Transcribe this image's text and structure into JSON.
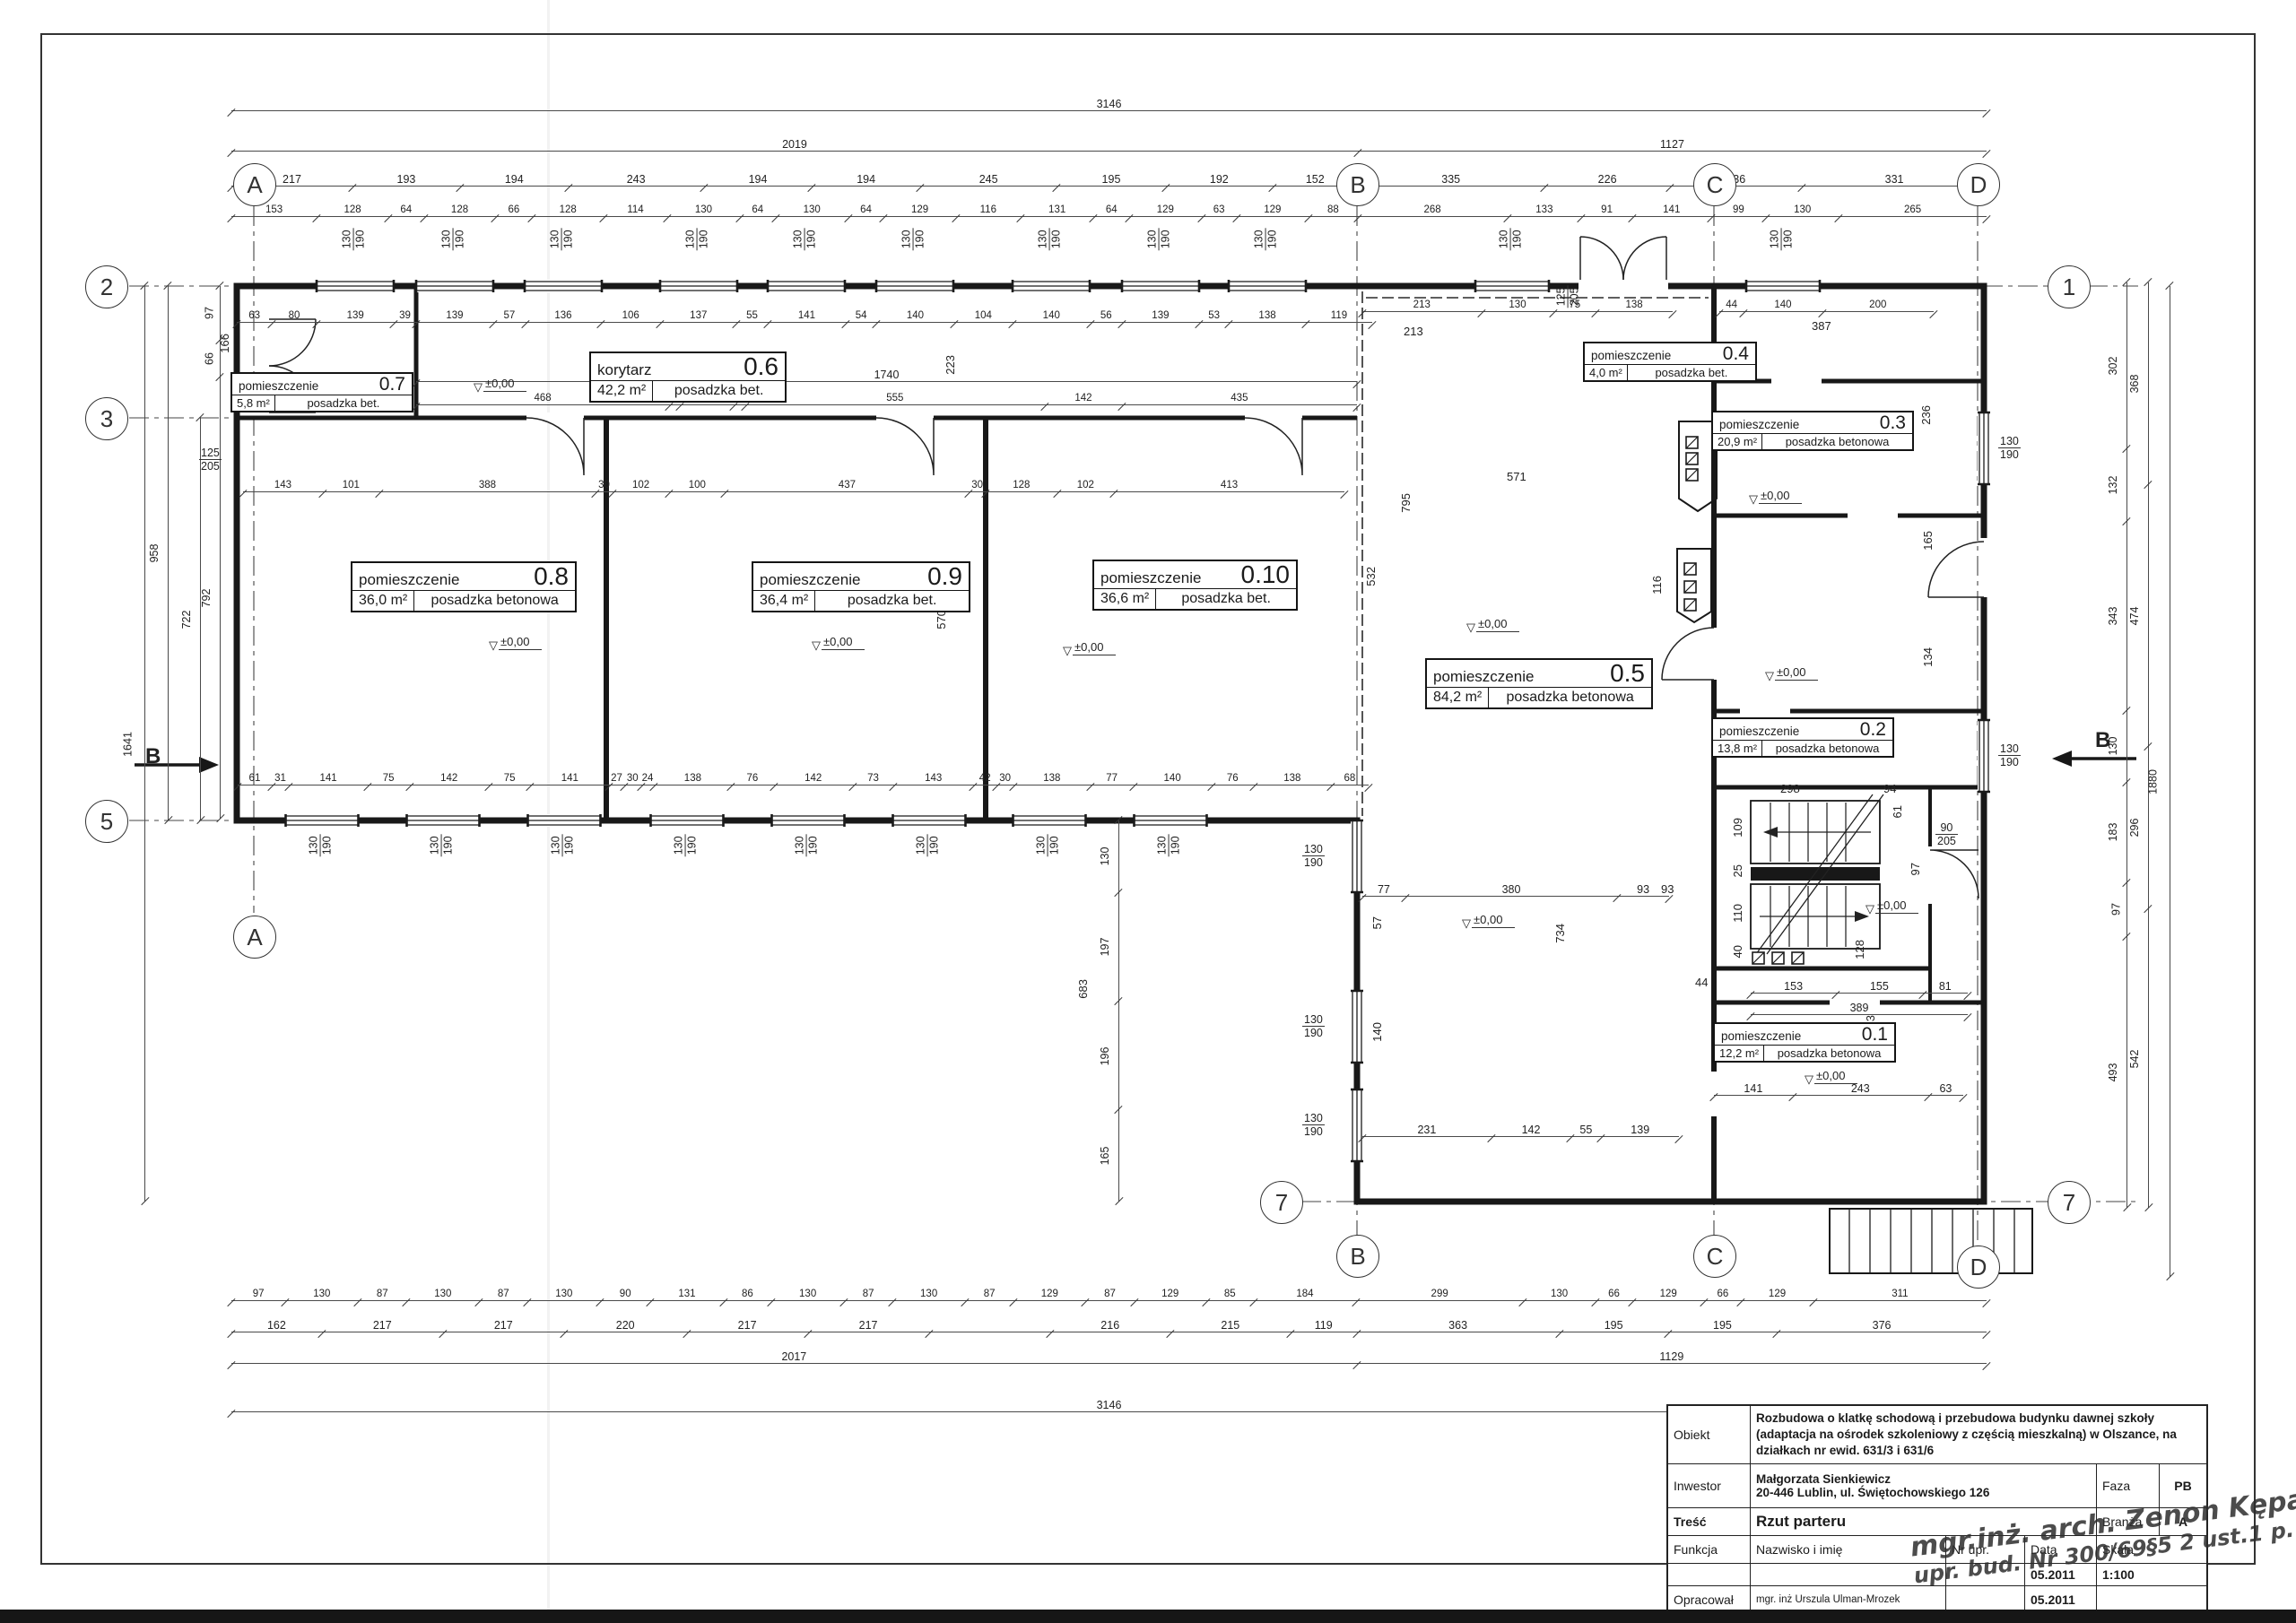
{
  "axes": {
    "a": "A",
    "b": "B",
    "c": "C",
    "d": "D",
    "n1": "1",
    "n2": "2",
    "n3": "3",
    "n5": "5",
    "n7": "7",
    "section": "B"
  },
  "labels": {
    "win_w": "130",
    "win_h": "190",
    "door_w": "90",
    "door_h": "205",
    "door2_w": "125",
    "door2_h": "205",
    "level": "±0,00"
  },
  "rooms": [
    {
      "label": "pomieszczenie",
      "num": "0.7",
      "area": "5,8 m²",
      "floor": "posadzka bet."
    },
    {
      "label": "korytarz",
      "num": "0.6",
      "area": "42,2 m²",
      "floor": "posadzka bet."
    },
    {
      "label": "pomieszczenie",
      "num": "0.8",
      "area": "36,0 m²",
      "floor": "posadzka betonowa"
    },
    {
      "label": "pomieszczenie",
      "num": "0.9",
      "area": "36,4 m²",
      "floor": "posadzka bet."
    },
    {
      "label": "pomieszczenie",
      "num": "0.10",
      "area": "36,6 m²",
      "floor": "posadzka bet."
    },
    {
      "label": "pomieszczenie",
      "num": "0.5",
      "area": "84,2 m²",
      "floor": "posadzka betonowa"
    },
    {
      "label": "pomieszczenie",
      "num": "0.4",
      "area": "4,0 m²",
      "floor": "posadzka bet."
    },
    {
      "label": "pomieszczenie",
      "num": "0.3",
      "area": "20,9 m²",
      "floor": "posadzka betonowa"
    },
    {
      "label": "pomieszczenie",
      "num": "0.2",
      "area": "13,8 m²",
      "floor": "posadzka betonowa"
    },
    {
      "label": "pomieszczenie",
      "num": "0.1",
      "area": "12,2 m²",
      "floor": "posadzka betonowa"
    }
  ],
  "chains": {
    "t1": [
      "3146"
    ],
    "t2": [
      "2019",
      "1127"
    ],
    "t3": [
      "217",
      "193",
      "194",
      "243",
      "194",
      "194",
      "245",
      "195",
      "192",
      "152",
      "335",
      "226",
      "236",
      "331"
    ],
    "t4": [
      "153",
      "128",
      "64",
      "128",
      "66",
      "128",
      "114",
      "130",
      "64",
      "130",
      "64",
      "129",
      "116",
      "131",
      "64",
      "129",
      "63",
      "129",
      "88",
      "268",
      "133",
      "91",
      "141",
      "99",
      "130",
      "265"
    ],
    "cti": [
      "63",
      "80",
      "139",
      "39",
      "139",
      "57",
      "136",
      "106",
      "137",
      "55",
      "141",
      "54",
      "140",
      "104",
      "140",
      "56",
      "139",
      "53",
      "138",
      "119"
    ],
    "c0": [
      "1740"
    ],
    "c1": [
      "468",
      "20",
      "100",
      "20",
      "555",
      "142",
      "435"
    ],
    "c2": [
      "143",
      "101",
      "388",
      "30",
      "102",
      "100",
      "437",
      "30",
      "128",
      "102",
      "413"
    ],
    "c3": [
      "61",
      "31",
      "141",
      "75",
      "142",
      "75",
      "141",
      "27",
      "30",
      "24",
      "138",
      "76",
      "142",
      "73",
      "143",
      "42",
      "30",
      "138",
      "77",
      "140",
      "76",
      "138",
      "68"
    ],
    "rt1": [
      "213",
      "130",
      "75",
      "138"
    ],
    "rt2": [
      "44",
      "140",
      "200"
    ],
    "m2": [
      "77",
      "380",
      "93"
    ],
    "bm": [
      "231",
      "142",
      "55",
      "139"
    ],
    "s1": [
      "153",
      "155",
      "81"
    ],
    "s2": [
      "389"
    ],
    "r01": [
      "141",
      "243",
      "63"
    ],
    "b1": [
      "97",
      "130",
      "87",
      "130",
      "87",
      "130",
      "90",
      "131",
      "86",
      "130",
      "87",
      "130",
      "87",
      "129",
      "87",
      "129",
      "85",
      "184",
      "299",
      "130",
      "66",
      "129",
      "66",
      "129",
      "311"
    ],
    "b2": [
      "162",
      "217",
      "217",
      "220",
      "217",
      "217",
      "~217",
      "216",
      "215",
      "119",
      "363",
      "195",
      "195",
      "376"
    ],
    "b3": [
      "2017",
      "1129"
    ],
    "b4": [
      "3146"
    ],
    "vl1": [
      "1641"
    ],
    "vl2": [
      "958"
    ],
    "vl3": [
      "722"
    ],
    "vl4": [
      "97",
      "66",
      "792"
    ],
    "vm1": [
      "130",
      "197",
      "196",
      "165"
    ],
    "vr1": [
      "302",
      "132",
      "343",
      "130",
      "183",
      "97",
      "493"
    ],
    "vr2": [
      "368",
      "474",
      "296",
      "542"
    ],
    "vr3": [
      "1880"
    ]
  },
  "inline_dims": [
    "571",
    "795",
    "532",
    "116",
    "734",
    "380",
    "93",
    "298",
    "94",
    "109",
    "25",
    "110",
    "40",
    "128",
    "44",
    "61",
    "97",
    "387",
    "213",
    "236",
    "165",
    "134",
    "233",
    "57",
    "140",
    "166",
    "223",
    "570",
    "683"
  ],
  "title_block": {
    "obiekt_label": "Obiekt",
    "obiekt": "Rozbudowa o klatkę schodową i przebudowa budynku dawnej szkoły (adaptacja na ośrodek szkoleniowy z częścią mieszkalną) w Olszance, na działkach nr ewid. 631/3 i 631/6",
    "inwestor_label": "Inwestor",
    "inwestor_line1": "Małgorzata Sienkiewicz",
    "inwestor_line2": "20-446 Lublin, ul. Świętochowskiego 126",
    "faza_label": "Faza",
    "faza": "PB",
    "tresc_label": "Treść",
    "tresc": "Rzut parteru",
    "branza_label": "Branża",
    "branza": "A",
    "funkcja_label": "Funkcja",
    "nazwisko_label": "Nazwisko i imię",
    "nrupr_label": "Nr upr.",
    "data_label": "Data",
    "skala_label": "Skala",
    "skala": "1:100",
    "data_mid": "05.2011",
    "opracowal_label": "Opracował",
    "opracowal_name": "mgr. inż Urszula Ulman-Mrozek",
    "data_bottom": "05.2011"
  },
  "stamp": {
    "line1": "mgr.inż. arch. Zenon Kępa",
    "line2": "upr. bud. Nr 300/69§5 2 ust.1 p. 1 i 2"
  }
}
